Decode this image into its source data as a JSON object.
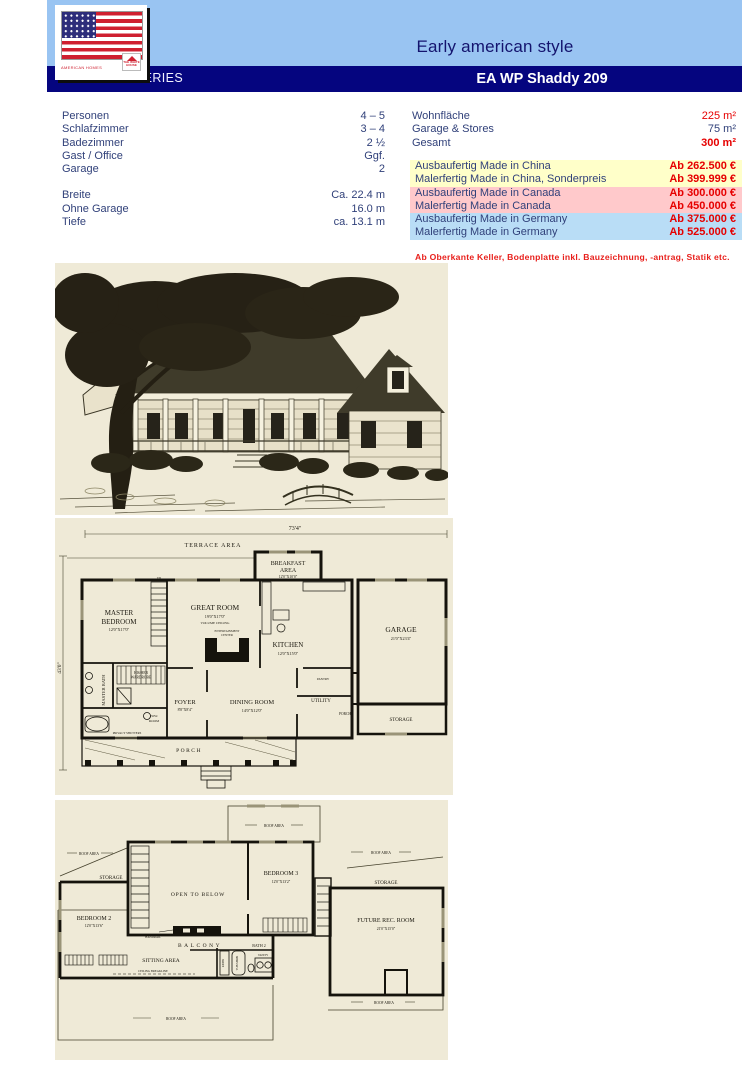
{
  "header": {
    "style_title": "Early american style",
    "series_label": "STANDARD SERIES",
    "model_title": "EA WP Shaddy 209",
    "logo_brand": "AMERICAN HOMES",
    "logo_badge": "THE WHITE HOUSE"
  },
  "colors": {
    "header_blue": "#99c4f2",
    "banner_navy": "#05057f",
    "text_navy": "#31417a",
    "accent_red": "#e60000",
    "row_yellow": "#ffffc9",
    "row_pink": "#ffc9cb",
    "row_blue": "#b9ddf6",
    "figure_beige": "#efead7"
  },
  "specs_left": [
    {
      "label": "Personen",
      "value": "4 – 5"
    },
    {
      "label": "Schlafzimmer",
      "value": "3 – 4"
    },
    {
      "label": "Badezimmer",
      "value": "2 ½"
    },
    {
      "label": "Gast / Office",
      "value": "Ggf."
    },
    {
      "label": "Garage",
      "value": "2"
    },
    {
      "label": "Breite",
      "value": "Ca. 22.4 m"
    },
    {
      "label": "Ohne Garage",
      "value": "16.0 m"
    },
    {
      "label": "Tiefe",
      "value": "ca. 13.1 m"
    }
  ],
  "specs_right": [
    {
      "label": "Wohnfläche",
      "value": "225 m²"
    },
    {
      "label": "Garage & Stores",
      "value": "75 m²"
    },
    {
      "label": "Gesamt",
      "value": "300 m²"
    }
  ],
  "prices": [
    {
      "label": "Ausbaufertig Made in China",
      "value": "Ab 262.500 €"
    },
    {
      "label": "Malerfertig Made in China, Sonderpreis",
      "value": "Ab 399.999 €"
    },
    {
      "label": "Ausbaufertig Made in Canada",
      "value": "Ab 300.000 €"
    },
    {
      "label": "Malerfertig Made in Canada",
      "value": "Ab 450.000 €"
    },
    {
      "label": "Ausbaufertig Made in Germany",
      "value": "Ab 375.000 €"
    },
    {
      "label": "Malerfertig Made in Germany",
      "value": "Ab 525.000 €"
    }
  ],
  "footnote": "Ab Oberkante Keller, Bodenplatte inkl. Bauzeichnung, -antrag, Statik etc.",
  "plan1": {
    "width_dim": "73'4\"",
    "depth_dim": "43'0\"",
    "terrace": "TERRACE AREA",
    "breakfast_1": "BREAKFAST",
    "breakfast_2": "AREA",
    "breakfast_size": "12'0\"X10'0\"",
    "master_1": "MASTER",
    "master_2": "BEDROOM",
    "master_size": "12'0\"X17'0\"",
    "great": "GREAT ROOM",
    "great_size": "19'0\"X17'0\"",
    "great_note": "VOLUME CEILING",
    "ent_1": "ENTERTAINMENT",
    "ent_2": "CENTER",
    "kitchen": "KITCHEN",
    "kitchen_size": "12'0\"X15'0\"",
    "garage": "GARAGE",
    "garage_size": "21'0\"X23'4\"",
    "master_bath": "MASTER BATH",
    "wardrobe_1": "HIS/HER",
    "wardrobe_2": "WARDROBE",
    "foyer": "FOYER",
    "foyer_size": "8'8\"X8'4\"",
    "dining": "DINING ROOM",
    "dining_size": "14'0\"X12'0\"",
    "utility": "UTILITY",
    "pantry": "PANTRY",
    "pow_1": "POW.",
    "pow_2": "ROOM",
    "porch": "PORCH",
    "rear_porch": "PORCH",
    "storage": "STORAGE",
    "privacy": "PRIVACY SHUTTERS",
    "up": "UP"
  },
  "plan2": {
    "roof_area": "ROOF AREA",
    "storage": "STORAGE",
    "bedroom2": "BEDROOM 2",
    "bedroom2_size": "12'0\"X13'6\"",
    "bedroom3": "BEDROOM 3",
    "bedroom3_size": "12'0\"X13'2\"",
    "open_below": "OPEN TO BELOW",
    "balcony": "BALCONY",
    "handrail": "HANDRAIL",
    "sitting": "SITTING AREA",
    "breakline": "CEILING BREAKLINE",
    "bath2": "BATH 2",
    "vanity": "VANITY",
    "tub": "TUB/SHWR",
    "linen": "LINEN",
    "future": "FUTURE REC. ROOM",
    "future_size": "21'0\"X15'0\""
  }
}
